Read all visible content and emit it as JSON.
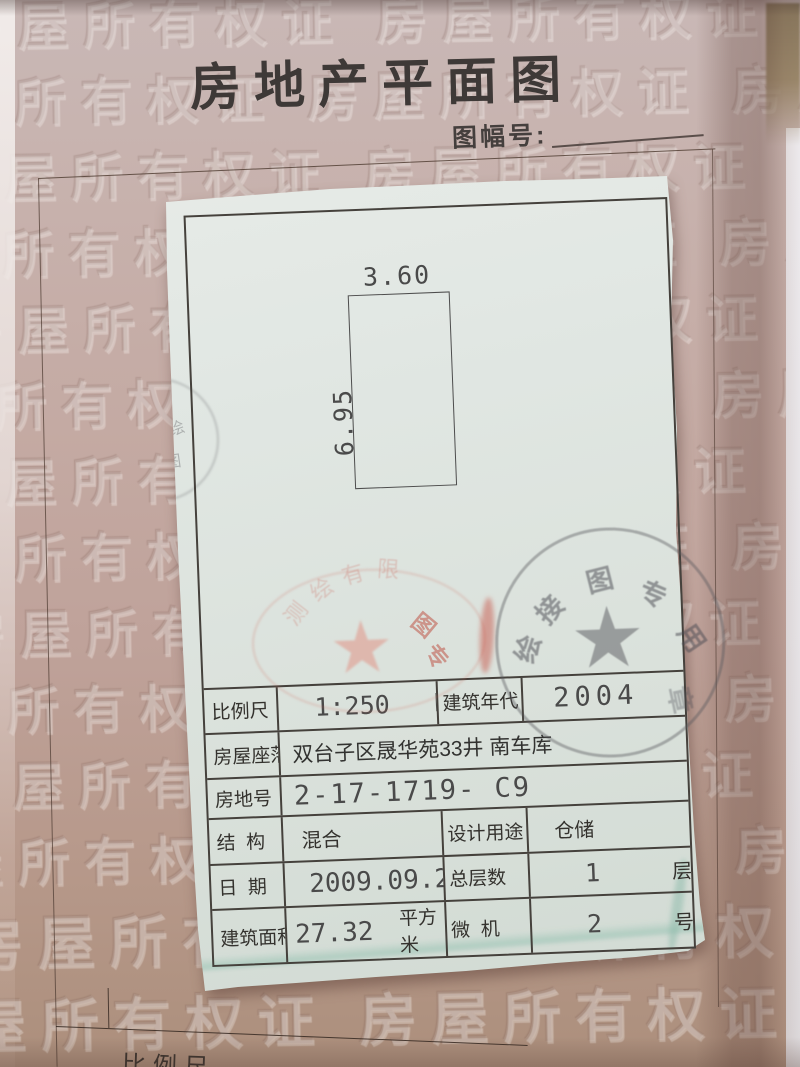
{
  "header": {
    "title": "房地产平面图",
    "sheet_label": "图幅号:"
  },
  "plan": {
    "width": "3.60",
    "height": "6.95"
  },
  "table": {
    "scale_label": "比例尺",
    "scale_value": "1:250   M",
    "year_label": "建筑年代",
    "year_value": "2004",
    "location_label": "房屋座落",
    "location_value": "双台子区晟华苑33井 南车库",
    "parcel_label": "房地号",
    "parcel_value": "2-17-1719- C9",
    "structure_label": "结  构",
    "structure_value": "混合",
    "usage_label": "设计用途",
    "usage_value": "仓储",
    "date_label": "日  期",
    "date_value": "2009.09.29",
    "floors_label": "总层数",
    "floors_value": "1",
    "floors_unit": "层",
    "area_label": "建筑面积",
    "area_value": "27.32",
    "area_unit": "平方米",
    "computer_label": "微  机",
    "computer_value": "2",
    "computer_unit": "号"
  },
  "stamps": {
    "gray": {
      "star": "★",
      "chars": [
        "绘",
        "接",
        "图",
        "专",
        "用",
        "章"
      ]
    },
    "red": {
      "star": "★",
      "arc_chars": [
        "测",
        "绘",
        "有",
        "限"
      ],
      "side_chars": [
        "图",
        "专"
      ],
      "edge_chars": [
        "绘",
        "图"
      ]
    }
  },
  "watermark": {
    "text": "房屋所有权证",
    "row": "房屋所有权证 房屋所有权证 房屋所有权证"
  },
  "underlying": {
    "partial_scale_label": "比例尺"
  },
  "colors": {
    "page_pink": "#c4a8a2",
    "paper_white": "#e2e7e3",
    "stamp_red": "#c05548",
    "stamp_gray": "#5c5c62",
    "line_dark": "#45413c"
  }
}
